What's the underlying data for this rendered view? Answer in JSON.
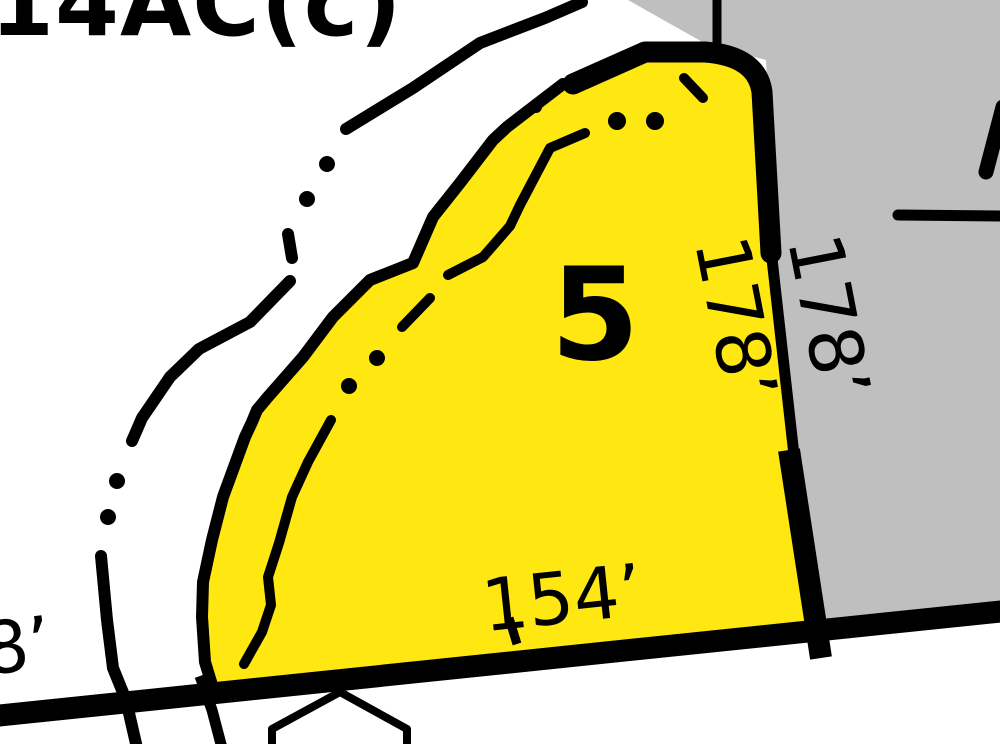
{
  "map": {
    "area_label": "14AC(c)",
    "lot": {
      "number": "5"
    },
    "dimensions": {
      "side_inner": "178’",
      "side_outer": "178’",
      "frontage": "154’",
      "edge_partial": "8’"
    },
    "colors": {
      "parcel_fill": "#FFE712",
      "adjacent_fill": "#BFBFBF",
      "line": "#000000",
      "background": "#FFFFFF"
    }
  }
}
